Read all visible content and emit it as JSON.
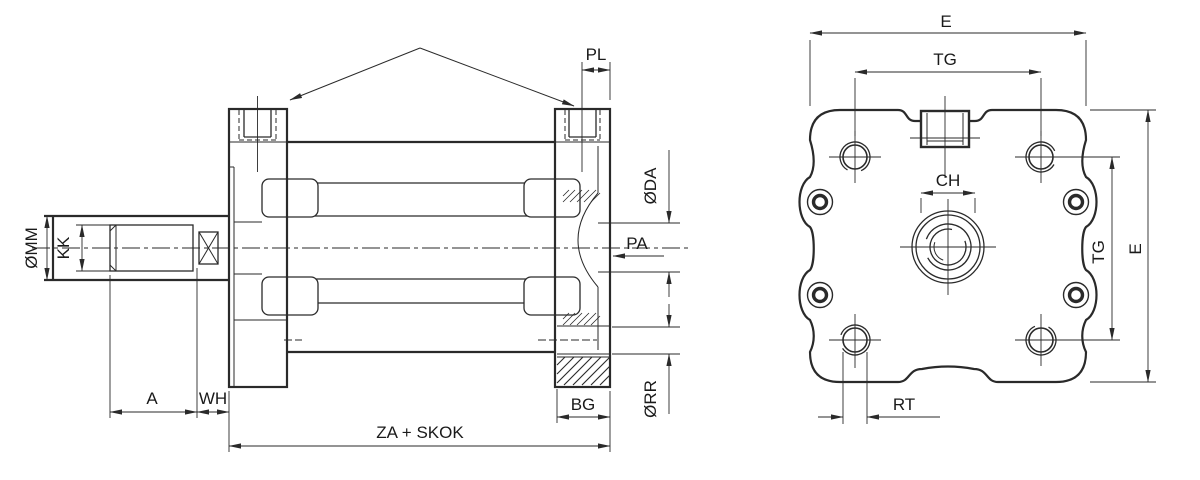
{
  "document": {
    "title": "Compact pneumatic cylinder — dimensional drawing",
    "background": "#ffffff"
  },
  "colors": {
    "line": "#2a2a2a",
    "text": "#1a1a1a"
  },
  "side_view": {
    "name": "Longitudinal section view",
    "labels": {
      "pl": "PL",
      "da": "ØDA",
      "pa": "PA",
      "mm": "ØMM",
      "kk": "KK",
      "a": "A",
      "wh": "WH",
      "za_stroke": "ZA + SKOK",
      "bg": "BG",
      "rr": "ØRR"
    }
  },
  "end_view": {
    "name": "End view",
    "labels": {
      "e_top": "E",
      "tg_top": "TG",
      "ch": "CH",
      "tg_side": "TG",
      "e_side": "E",
      "rt": "RT"
    }
  }
}
